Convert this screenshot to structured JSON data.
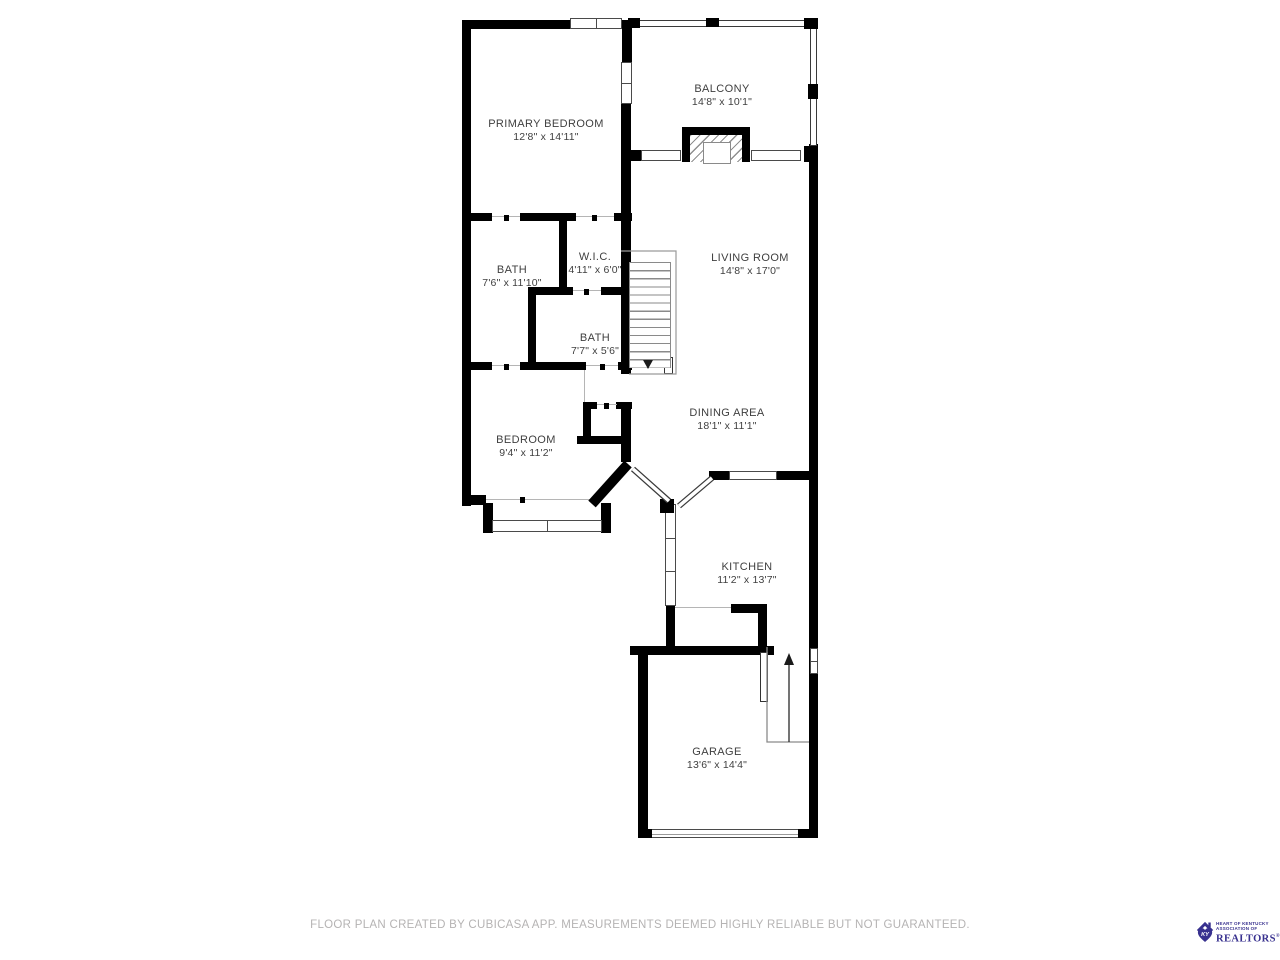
{
  "plan": {
    "rooms": [
      {
        "name": "PRIMARY BEDROOM",
        "dims": "12'8\" x 14'11\""
      },
      {
        "name": "BALCONY",
        "dims": "14'8\" x 10'1\""
      },
      {
        "name": "BATH",
        "dims": "7'6\" x 11'10\""
      },
      {
        "name": "W.I.C.",
        "dims": "4'11\" x 6'0\""
      },
      {
        "name": "LIVING ROOM",
        "dims": "14'8\" x 17'0\""
      },
      {
        "name": "BATH",
        "dims": "7'7\" x 5'6\""
      },
      {
        "name": "BEDROOM",
        "dims": "9'4\" x 11'2\""
      },
      {
        "name": "DINING AREA",
        "dims": "18'1\" x 11'1\""
      },
      {
        "name": "KITCHEN",
        "dims": "11'2\" x 13'7\""
      },
      {
        "name": "GARAGE",
        "dims": "13'6\" x 14'4\""
      }
    ],
    "colors": {
      "wall": "#000000",
      "thin_line": "#8a8a8a",
      "label_text": "#3f3f3f"
    }
  },
  "footer": {
    "disclaimer": "FLOOR PLAN CREATED BY CUBICASA APP. MEASUREMENTS DEEMED HIGHLY RELIABLE BUT NOT GUARANTEED."
  },
  "logo": {
    "monogram": "KY",
    "line1": "HEART OF KENTUCKY",
    "line2": "ASSOCIATION OF",
    "realtors": "REALTORS",
    "registered": "®",
    "color": "#38318f"
  }
}
